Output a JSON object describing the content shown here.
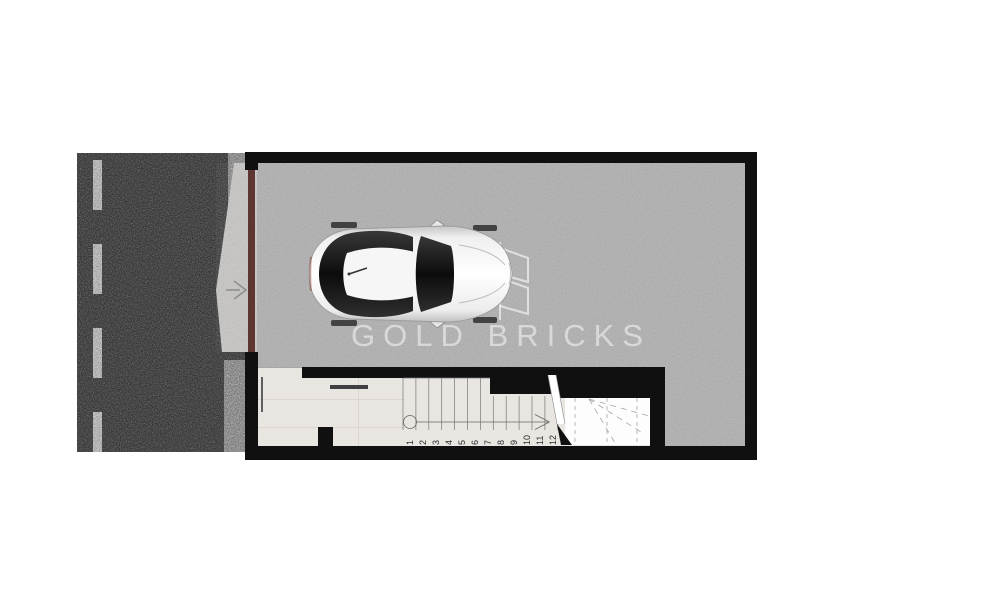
{
  "watermark": {
    "text": "GOLD BRICKS",
    "logo_name": "gold-bricks-monogram"
  },
  "stairs": {
    "step_count": 12,
    "numbers": [
      "1",
      "2",
      "3",
      "4",
      "5",
      "6",
      "7",
      "8",
      "9",
      "10",
      "11",
      "12"
    ]
  },
  "entry": {
    "direction": "right"
  },
  "scene": {
    "vehicle": "white car top view",
    "road_marking": "dashed center line",
    "garage_door": "dark red garage door",
    "stair_walkline": "circle start, arrow end"
  },
  "colors": {
    "wall": "#101010",
    "asphalt": "#3f3f3f",
    "gravel": "#969696",
    "concrete": "#b3b3b4",
    "corridor": "#e9e6e1",
    "landing": "#fdfdfd",
    "driveway": "#c8c7c5",
    "garage_door": "#5d3531",
    "lane_marking": "#dedede",
    "watermark": "rgba(255,255,255,0.5)",
    "stair_line": "#777777",
    "dash_line": "#a5a5a5"
  }
}
